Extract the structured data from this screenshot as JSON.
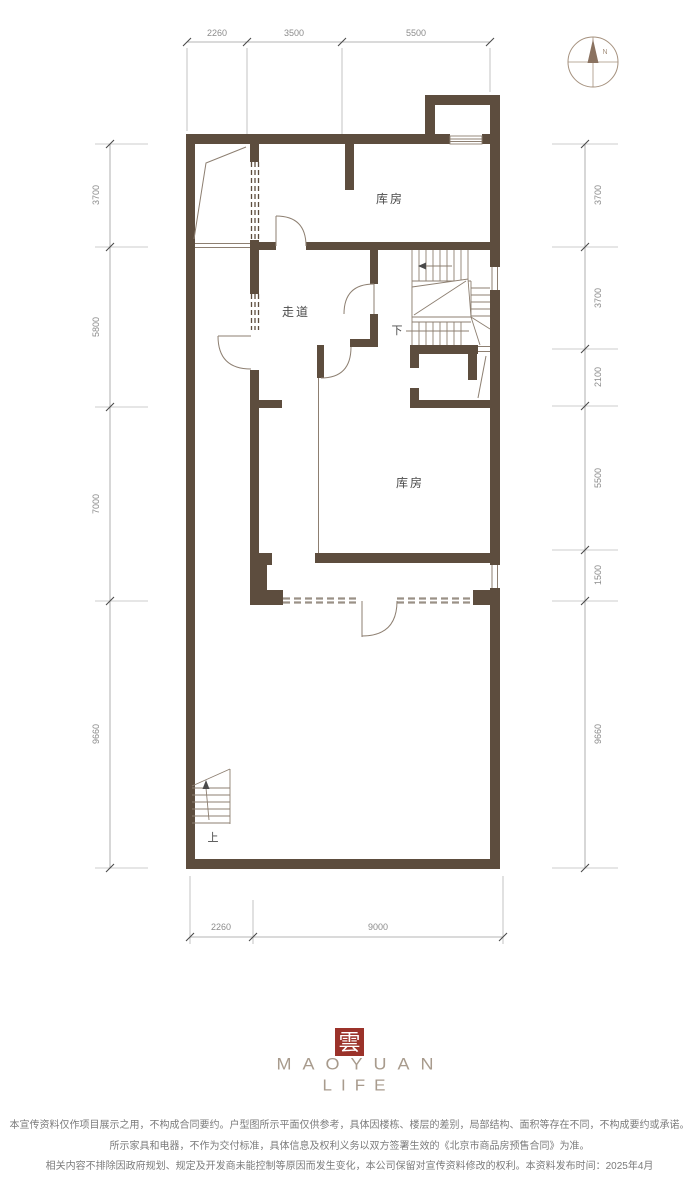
{
  "colors": {
    "wall": "#5d4d3e",
    "thin_line": "#8d7f71",
    "dash_low": "#9a9186",
    "dim_line": "#9b9b9b",
    "dim_text": "#8c8c8c",
    "label_text": "#4b4b4b",
    "compass": "#a5917e",
    "needle": "#8a7260",
    "seal_red": "#9b322a",
    "brand": "#a89b8d",
    "disclaimer": "#7b7b7b"
  },
  "compass": {
    "north_label": "N"
  },
  "rooms": [
    {
      "label": "库房"
    },
    {
      "label": "走道"
    },
    {
      "label": "库房"
    }
  ],
  "stairs": {
    "down_label": "下",
    "up_label": "上"
  },
  "dimensions": {
    "top": [
      "2260",
      "3500",
      "5500"
    ],
    "bottom": [
      "2260",
      "9000"
    ],
    "left": [
      "3700",
      "5800",
      "7000",
      "9660"
    ],
    "right": [
      "3700",
      "3700",
      "2100",
      "5500",
      "1500",
      "9660"
    ]
  },
  "footer": {
    "seal_character": "雲",
    "brand_line1": "MAOYUAN",
    "brand_line2": "LIFE",
    "disclaimers": [
      "本宣传资料仅作项目展示之用，不构成合同要约。户型图所示平面仅供参考，具体因楼栋、楼层的差别，局部结构、面积等存在不同，不构成要约或承诺。",
      "所示家具和电器，不作为交付标准，具体信息及权利义务以双方签署生效的《北京市商品房预售合同》为准。",
      "相关内容不排除因政府规划、规定及开发商未能控制等原因而发生变化，本公司保留对宣传资料修改的权利。本资料发布时间：2025年4月"
    ]
  }
}
